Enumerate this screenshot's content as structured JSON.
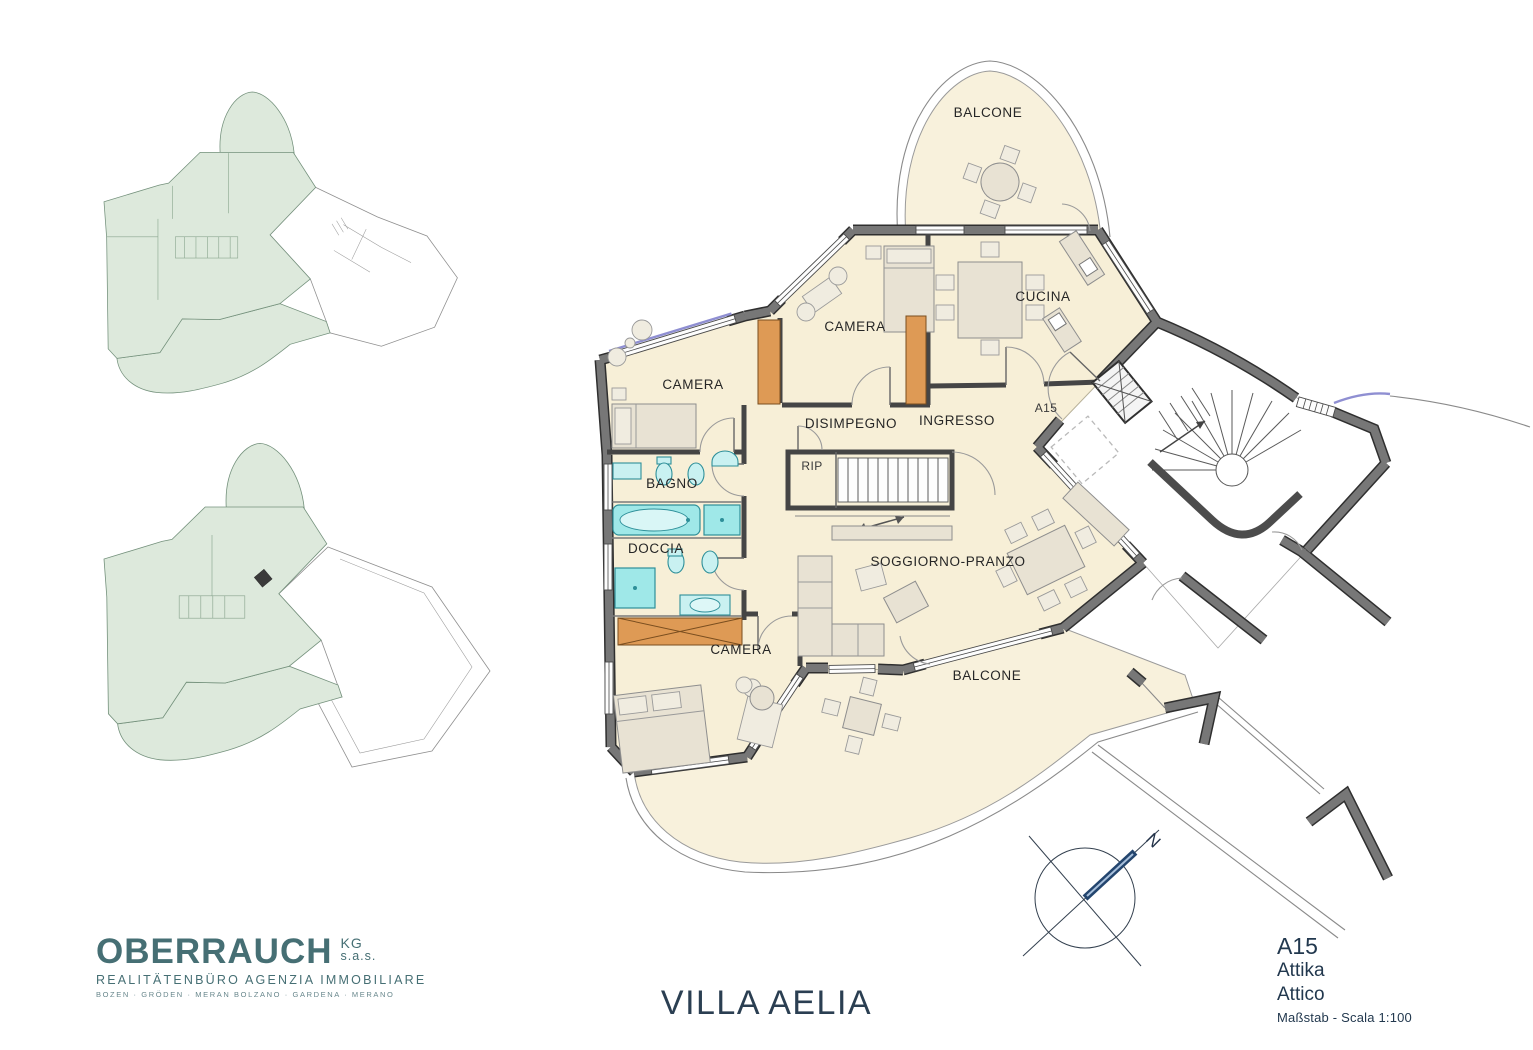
{
  "plan": {
    "rooms": {
      "balcone_top": "BALCONE",
      "cucina": "CUCINA",
      "camera_top": "CAMERA",
      "camera_left": "CAMERA",
      "camera_bottom": "CAMERA",
      "disimpegno": "DISIMPEGNO",
      "ingresso": "INGRESSO",
      "rip": "RIP",
      "bagno": "BAGNO",
      "doccia": "DOCCIA",
      "soggiorno": "SOGGIORNO-PRANZO",
      "balcone_bottom": "BALCONE",
      "unit_label": "A15"
    },
    "compass": {
      "north": "N"
    }
  },
  "footer": {
    "brand": {
      "name": "OBERRAUCH",
      "kg": "KG",
      "sas": "s.a.s.",
      "tagline": "REALITÄTENBÜRO   AGENZIA IMMOBILIARE",
      "cities": "BOZEN · GRÖDEN · MERAN     BOLZANO · GARDENA · MERANO"
    },
    "title": "VILLA AELIA",
    "info": {
      "unit": "A15",
      "floor_de": "Attika",
      "floor_it": "Attico",
      "scale": "Maßstab - Scala 1:100"
    }
  },
  "colors": {
    "floor": "#f7efd7",
    "wall": "#777777",
    "fixture": "#9fe8e8",
    "wardrobe": "#de9a55",
    "overview_highlight": "#dde9dc",
    "brand": "#466f74",
    "title": "#2b3f52"
  }
}
